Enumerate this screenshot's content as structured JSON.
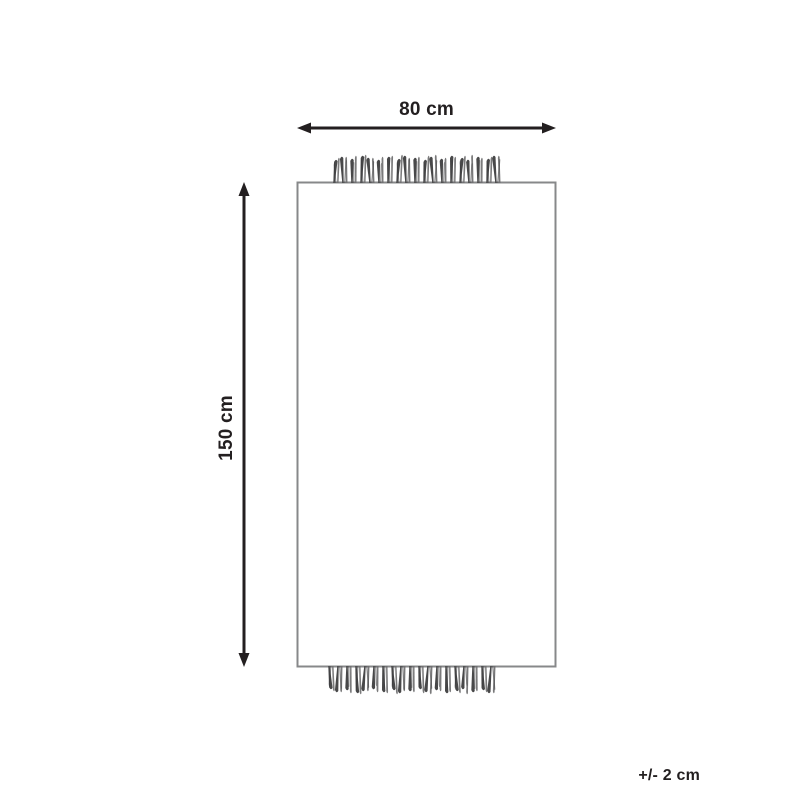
{
  "diagram": {
    "title": "rug-dimension-diagram",
    "width_label": "80 cm",
    "height_label": "150 cm",
    "tolerance_label": "+/- 2 cm",
    "colors": {
      "text": "#231f20",
      "arrow": "#231f20",
      "outline": "#87888a",
      "tassel_dark": "#38383a",
      "tassel_mid": "#6b6b6d"
    },
    "fringe": {
      "top_count": 19,
      "bottom_count": 19
    }
  }
}
